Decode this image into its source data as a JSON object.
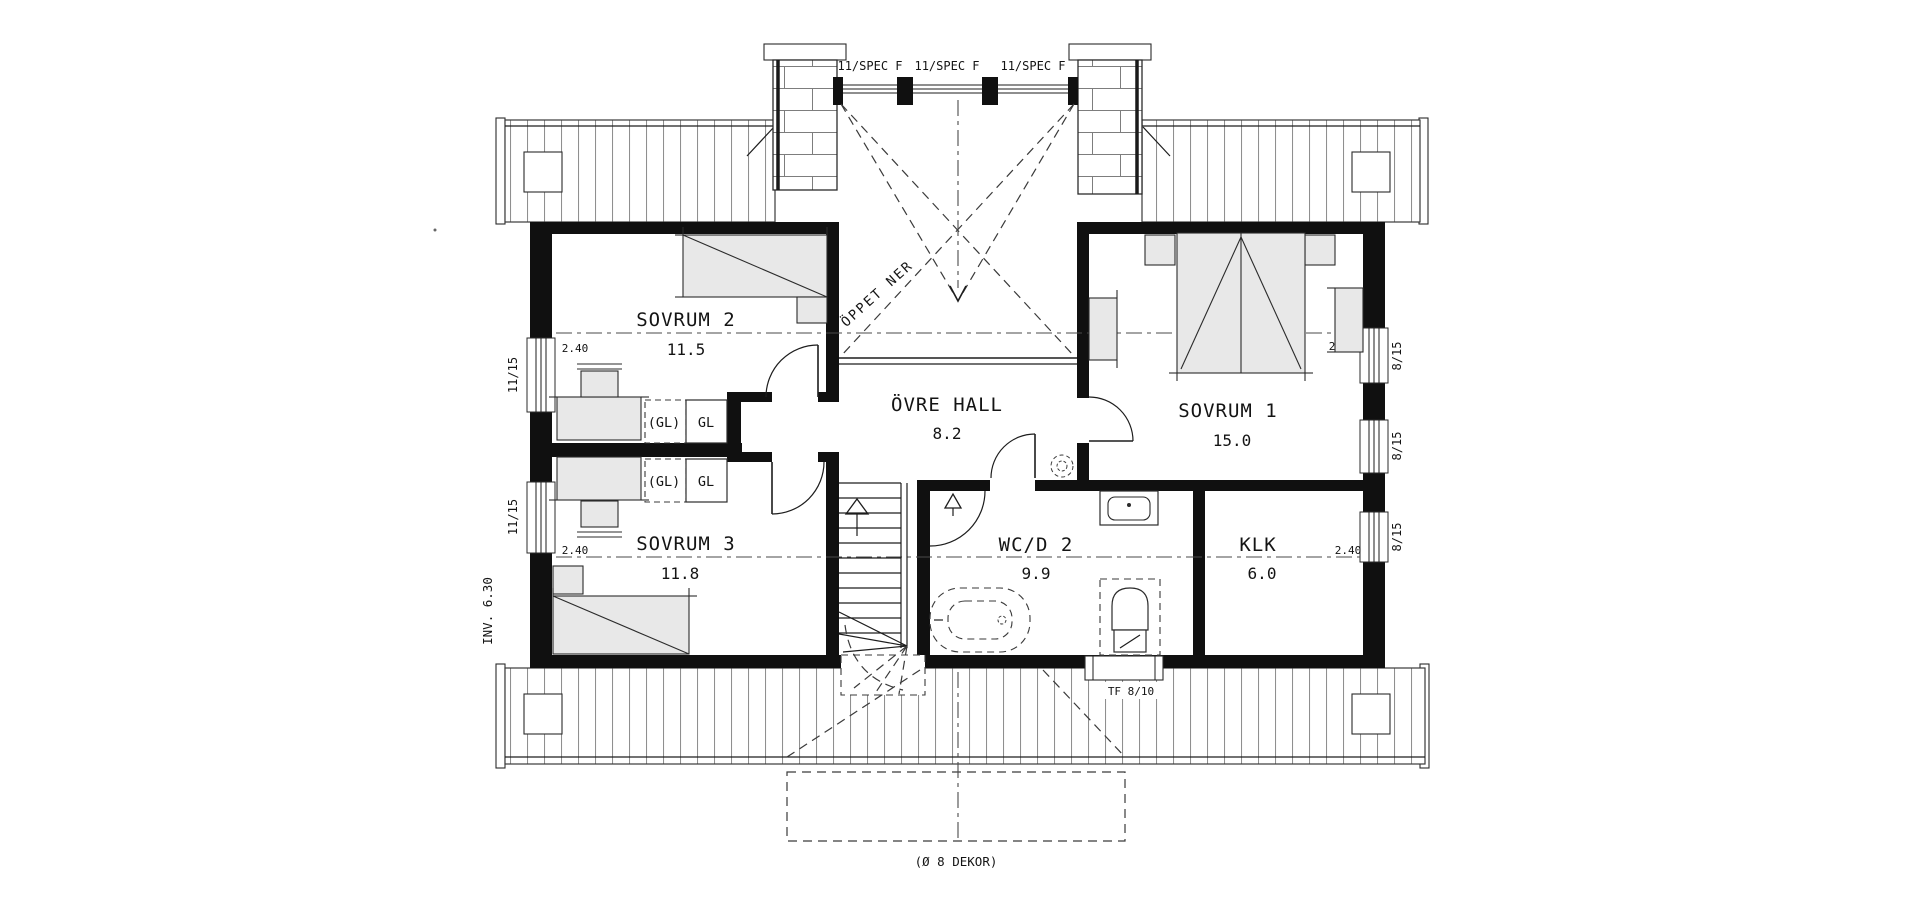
{
  "rooms": [
    {
      "name": "SOVRUM 2",
      "area": "11.5"
    },
    {
      "name": "SOVRUM 3",
      "area": "11.8"
    },
    {
      "name": "ÖVRE HALL",
      "area": "8.2"
    },
    {
      "name": "SOVRUM 1",
      "area": "15.0"
    },
    {
      "name": "WC/D 2",
      "area": "9.9"
    },
    {
      "name": "KLK",
      "area": "6.0"
    }
  ],
  "windows": {
    "top": [
      "11/SPEC F",
      "11/SPEC F",
      "11/SPEC F"
    ],
    "left": [
      "11/15",
      "11/15"
    ],
    "right": [
      "8/15",
      "8/15",
      "8/15"
    ],
    "bottom": "TF 8/10"
  },
  "closets": {
    "dashed": "(GL)",
    "solid": "GL"
  },
  "annotations": {
    "open_below": "ÖPPET NER",
    "inner_height": "INV. 6.30",
    "ceiling_height": "2.40",
    "decor": "(Ø 8 DEKOR)"
  }
}
